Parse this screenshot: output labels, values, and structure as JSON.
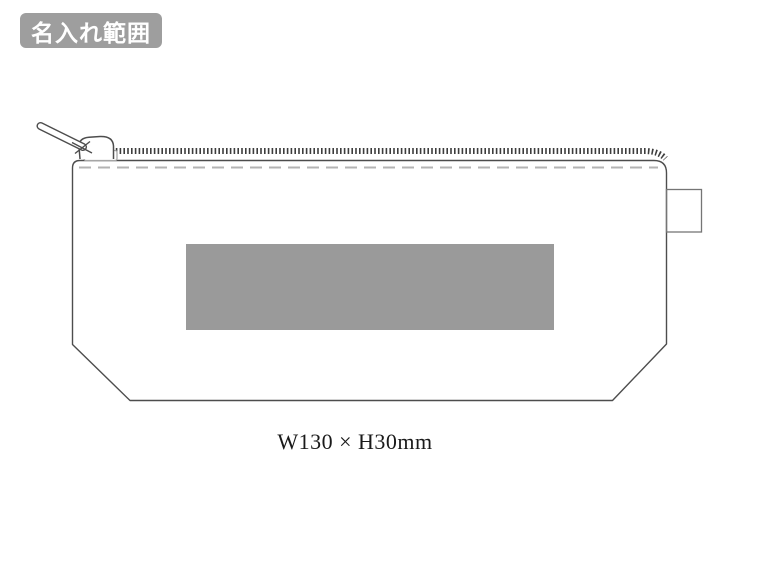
{
  "colors": {
    "badge-bg": "#9e9e9e",
    "badge-text": "#ffffff",
    "outline": "#4d4d4d",
    "outline-light": "#757575",
    "stitch": "#b3b3b3",
    "teeth": "#3d3d3d",
    "print-area": "#9a9a9a",
    "dimension-text": "#1a1a1a",
    "canvas": "#ffffff"
  },
  "badge": {
    "label": "名入れ範囲"
  },
  "dimension": {
    "label": "W130 × H30mm"
  }
}
